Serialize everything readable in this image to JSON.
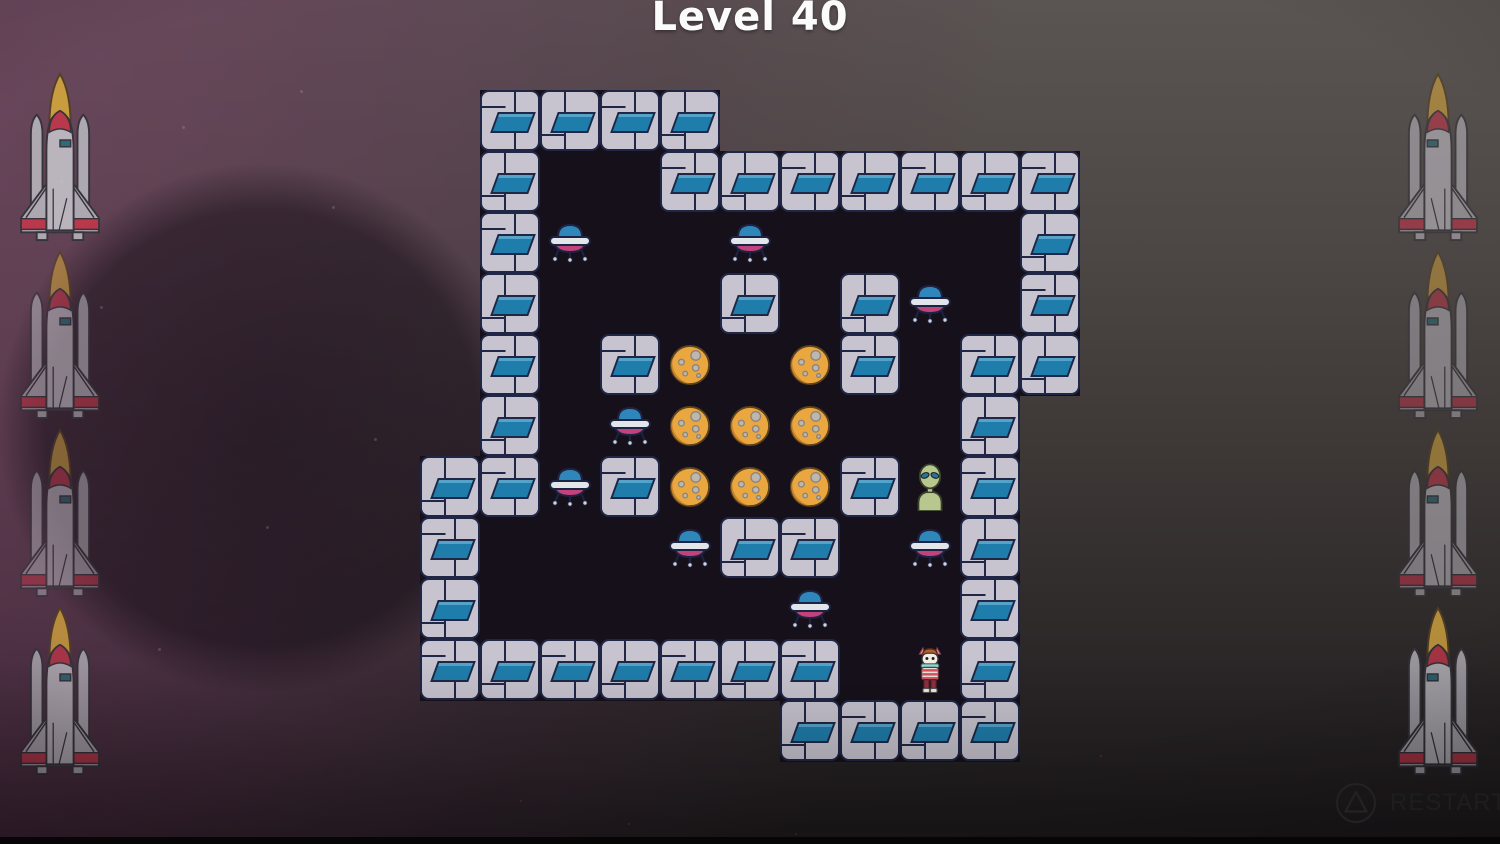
{
  "title": "Level 40",
  "hud": {
    "restart": {
      "label": "RESTART",
      "icon": "triangle-button-icon"
    }
  },
  "level": {
    "grid": {
      "origin_x": 420,
      "origin_y": 90,
      "cell_w": 60,
      "cell_h": 61,
      "cols": 11,
      "rows": 11
    },
    "floor_spans": [
      {
        "r": 0,
        "c0": 1,
        "c1": 4
      },
      {
        "r": 1,
        "c0": 1,
        "c1": 10
      },
      {
        "r": 2,
        "c0": 1,
        "c1": 10
      },
      {
        "r": 3,
        "c0": 1,
        "c1": 10
      },
      {
        "r": 4,
        "c0": 1,
        "c1": 10
      },
      {
        "r": 5,
        "c0": 1,
        "c1": 9
      },
      {
        "r": 6,
        "c0": 0,
        "c1": 9
      },
      {
        "r": 7,
        "c0": 0,
        "c1": 9
      },
      {
        "r": 8,
        "c0": 0,
        "c1": 9
      },
      {
        "r": 9,
        "c0": 0,
        "c1": 9
      },
      {
        "r": 10,
        "c0": 6,
        "c1": 9
      }
    ],
    "walls": [
      [
        0,
        1
      ],
      [
        0,
        2
      ],
      [
        0,
        3
      ],
      [
        0,
        4
      ],
      [
        1,
        1
      ],
      [
        1,
        4
      ],
      [
        1,
        5
      ],
      [
        1,
        6
      ],
      [
        1,
        7
      ],
      [
        1,
        8
      ],
      [
        1,
        9
      ],
      [
        1,
        10
      ],
      [
        2,
        1
      ],
      [
        2,
        10
      ],
      [
        3,
        1
      ],
      [
        3,
        5
      ],
      [
        3,
        7
      ],
      [
        3,
        10
      ],
      [
        4,
        1
      ],
      [
        4,
        3
      ],
      [
        4,
        7
      ],
      [
        4,
        9
      ],
      [
        4,
        10
      ],
      [
        5,
        1
      ],
      [
        5,
        9
      ],
      [
        6,
        0
      ],
      [
        6,
        1
      ],
      [
        6,
        3
      ],
      [
        6,
        7
      ],
      [
        6,
        9
      ],
      [
        7,
        0
      ],
      [
        7,
        5
      ],
      [
        7,
        6
      ],
      [
        7,
        9
      ],
      [
        8,
        0
      ],
      [
        8,
        9
      ],
      [
        9,
        0
      ],
      [
        9,
        1
      ],
      [
        9,
        2
      ],
      [
        9,
        3
      ],
      [
        9,
        4
      ],
      [
        9,
        5
      ],
      [
        9,
        6
      ],
      [
        9,
        9
      ],
      [
        10,
        6
      ],
      [
        10,
        7
      ],
      [
        10,
        8
      ],
      [
        10,
        9
      ]
    ],
    "entities": {
      "ufos": [
        [
          2,
          2
        ],
        [
          2,
          5
        ],
        [
          3,
          8
        ],
        [
          5,
          3
        ],
        [
          6,
          2
        ],
        [
          7,
          4
        ],
        [
          7,
          8
        ],
        [
          8,
          6
        ]
      ],
      "moons": [
        [
          4,
          4
        ],
        [
          4,
          6
        ],
        [
          5,
          4
        ],
        [
          5,
          5
        ],
        [
          5,
          6
        ],
        [
          6,
          4
        ],
        [
          6,
          5
        ],
        [
          6,
          6
        ]
      ],
      "alien": [
        6,
        8
      ],
      "player": [
        9,
        8
      ]
    }
  },
  "decorations": {
    "rockets": [
      {
        "x": 16,
        "y": 72,
        "opacity": 0.9,
        "flip": false
      },
      {
        "x": 16,
        "y": 250,
        "opacity": 0.58,
        "flip": false
      },
      {
        "x": 16,
        "y": 428,
        "opacity": 0.5,
        "flip": false
      },
      {
        "x": 16,
        "y": 606,
        "opacity": 0.78,
        "flip": false
      },
      {
        "x": 1394,
        "y": 72,
        "opacity": 0.6,
        "flip": true
      },
      {
        "x": 1394,
        "y": 250,
        "opacity": 0.5,
        "flip": true
      },
      {
        "x": 1394,
        "y": 428,
        "opacity": 0.55,
        "flip": true
      },
      {
        "x": 1394,
        "y": 606,
        "opacity": 0.8,
        "flip": true
      }
    ],
    "stars_white": [
      [
        182,
        126
      ],
      [
        332,
        206
      ],
      [
        100,
        306
      ],
      [
        266,
        526
      ],
      [
        374,
        438
      ],
      [
        158,
        648
      ],
      [
        60,
        180
      ],
      [
        300,
        90
      ]
    ],
    "stars_red": [
      [
        520,
        800
      ],
      [
        628,
        823
      ],
      [
        795,
        833
      ],
      [
        1100,
        755
      ]
    ]
  },
  "colors": {
    "tile": "#c7c4cf",
    "tile_border": "#202746",
    "tile_panel_blue": "#1f7dab",
    "floor": "#16101a",
    "moon": "#eba73f",
    "ufo_dome": "#2f86ba",
    "ufo_belly": "#c2427b",
    "alien_skin": "#b7c78e",
    "accent_red": "#c3374a",
    "tank_yellow": "#d5a63e",
    "title_text": "#fbfbfb",
    "restart_text": "#1e1e1e"
  }
}
